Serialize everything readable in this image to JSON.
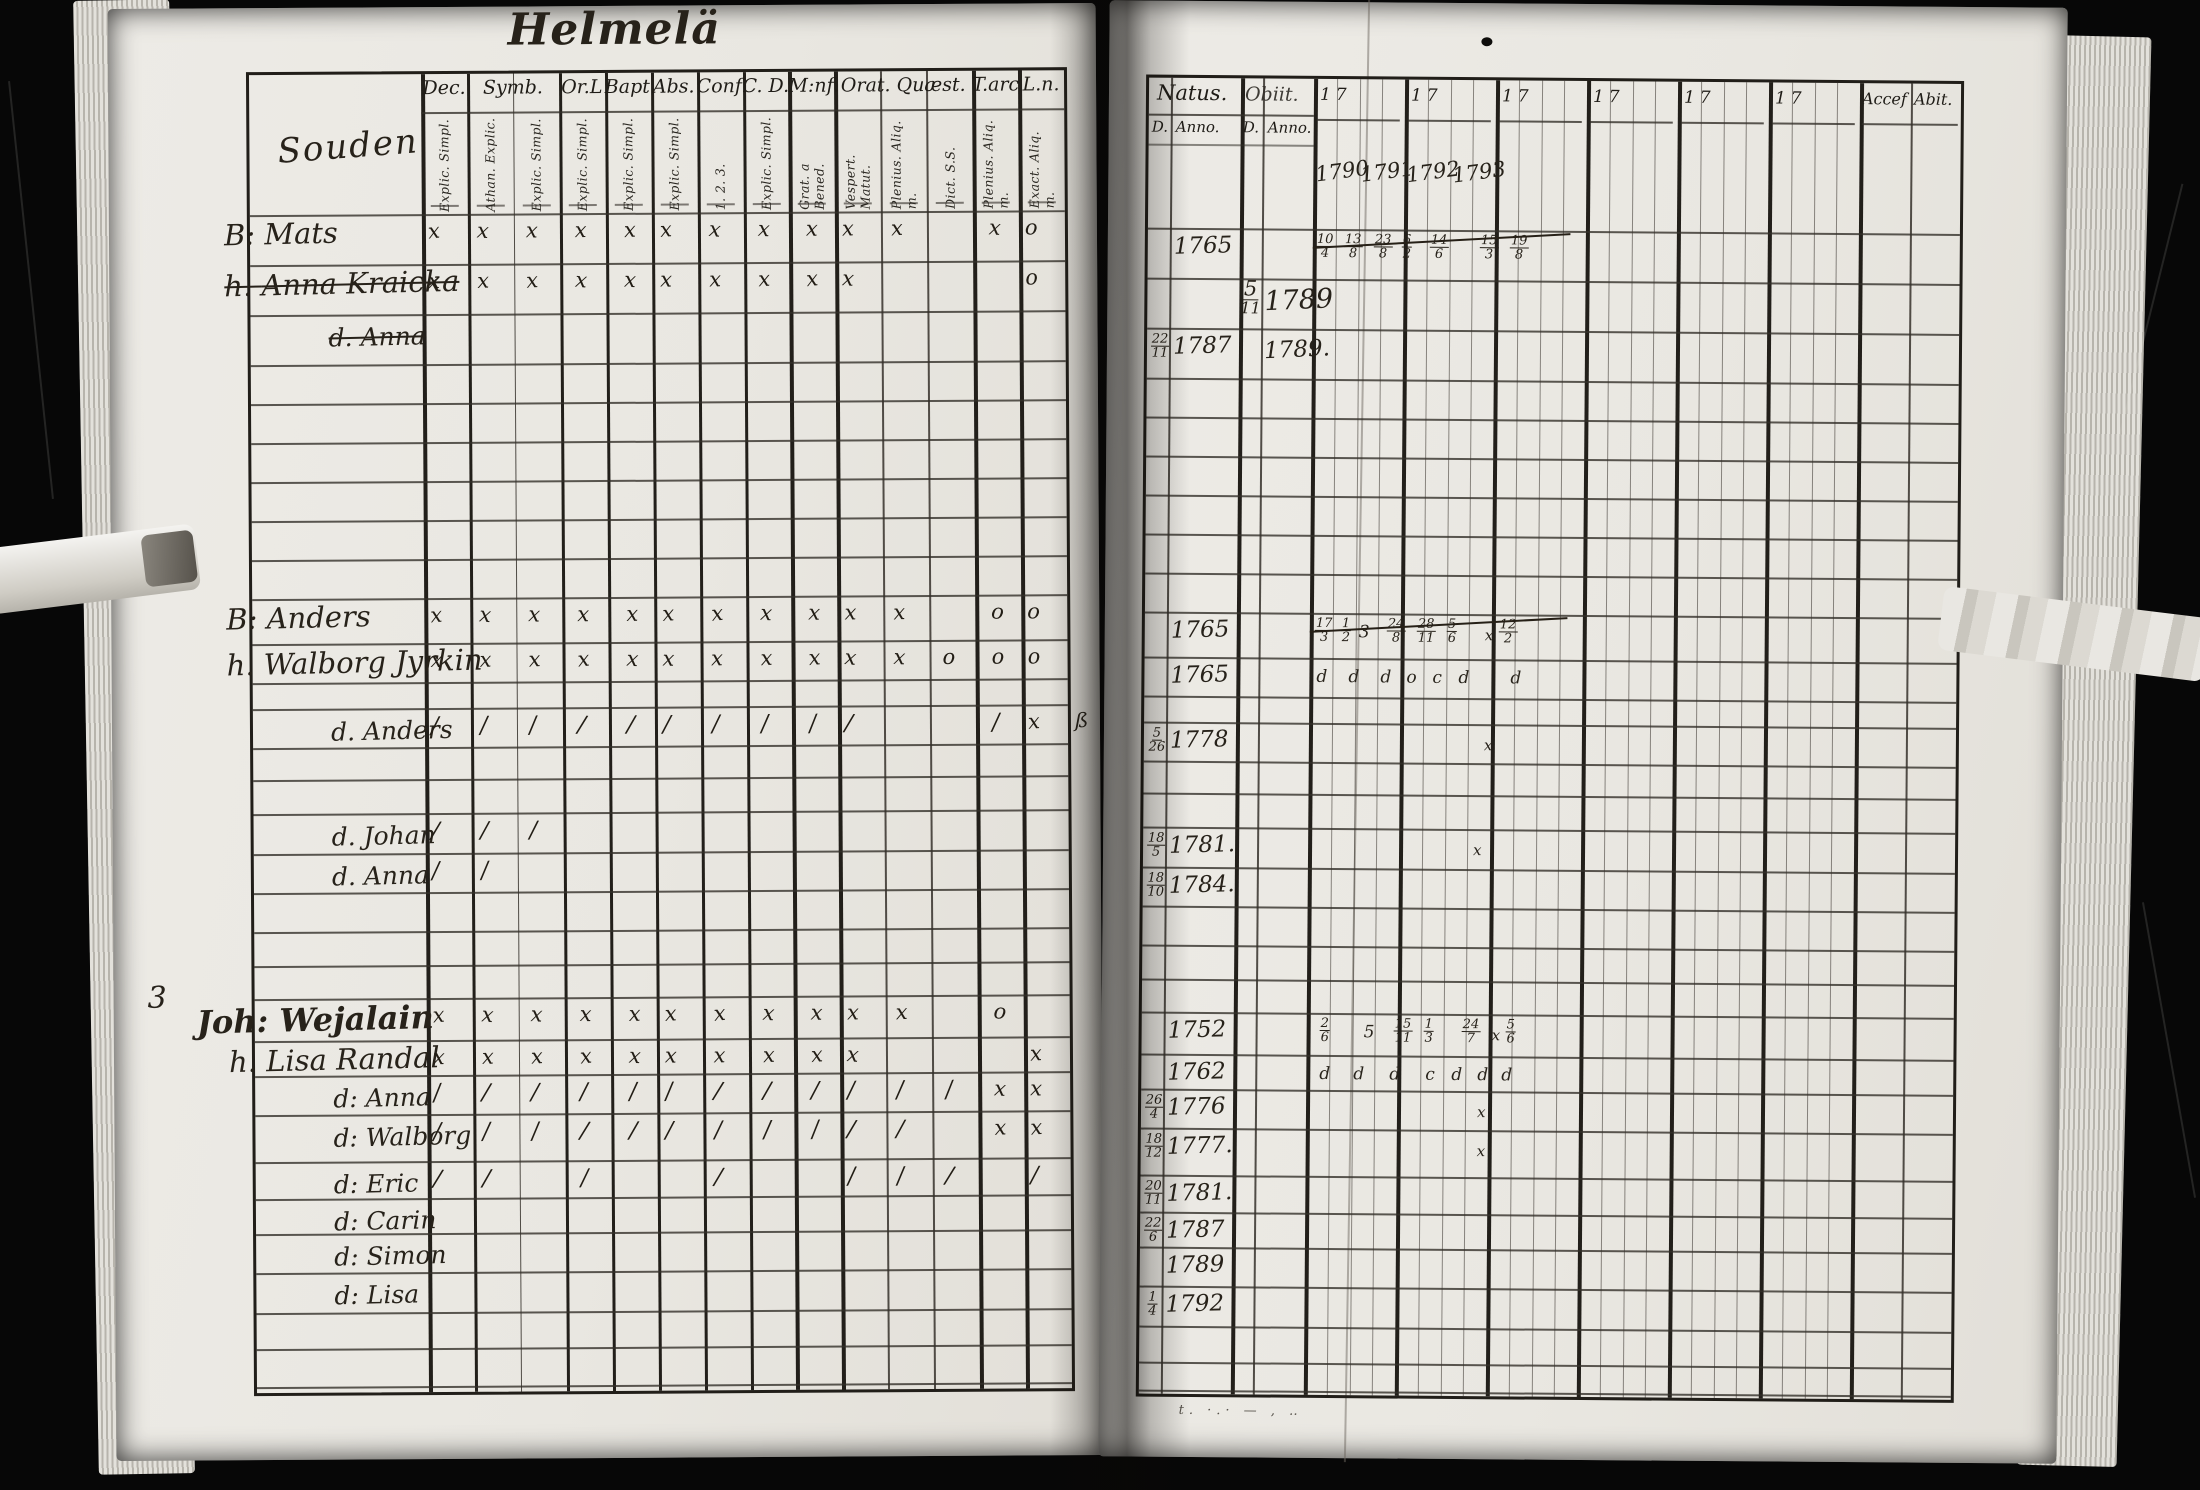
{
  "title": "Helmelä",
  "left_page": {
    "column_label": "Souden",
    "margin_note": "3",
    "header_groups": [
      {
        "label": "Dec.",
        "cols": [
          "Explic. Simpl."
        ]
      },
      {
        "label": "Symb.",
        "cols": [
          "Athan. Explic.",
          "Explic. Simpl."
        ]
      },
      {
        "label": "Or.L",
        "cols": [
          "Explic. Simpl."
        ]
      },
      {
        "label": "Bapt.",
        "cols": [
          "Explic. Simpl."
        ]
      },
      {
        "label": "Abs.",
        "cols": [
          "Explic. Simpl."
        ]
      },
      {
        "label": "Conf.",
        "cols": [
          "1. 2. 3."
        ]
      },
      {
        "label": "C. D.",
        "cols": [
          "Explic. Simpl."
        ]
      },
      {
        "label": "M:nf.",
        "cols": [
          "Grat. a Bened."
        ]
      },
      {
        "label": "Orat. Quæst.",
        "cols": [
          "Vespert. Matut.",
          "Plenius. Aliq. m.",
          "Dict. S.S."
        ]
      },
      {
        "label": "T.arc",
        "cols": [
          "Plenius. Aliq. m."
        ]
      },
      {
        "label": "L.n.",
        "cols": [
          "Exact. Aliq. m."
        ]
      }
    ]
  },
  "right_page": {
    "natus_label": "Natus.",
    "obiit_label": "Obiit.",
    "day_label": "D.",
    "anno_label": "Anno.",
    "year_prefix": "17",
    "written_years": [
      "1790",
      "1791",
      "1792",
      "1793"
    ],
    "accessit_label": "Accef",
    "abiit_label": "Abit.",
    "footer_scribble": "t. ·.· — , ‥"
  },
  "rows": [
    {
      "prefix": "B:",
      "name": "Mats",
      "struck": false,
      "child": false,
      "marks": [
        "x",
        "x",
        "x",
        "x",
        "x",
        "x",
        "x",
        "x",
        "x",
        "x",
        "x",
        "",
        "x",
        "o"
      ],
      "natus_anno": "1765",
      "notes_struck": true,
      "notes": [
        {
          "x": 168,
          "t": "10|4"
        },
        {
          "x": 196,
          "t": "13|8"
        },
        {
          "x": 226,
          "t": "23|8"
        },
        {
          "x": 254,
          "t": "6|2"
        },
        {
          "x": 282,
          "t": "14|6"
        },
        {
          "x": 332,
          "t": "15|3"
        },
        {
          "x": 362,
          "t": "19|8"
        }
      ]
    },
    {
      "prefix": "h.",
      "name": "Anna Kraicka",
      "struck": true,
      "child": false,
      "marks": [
        "x",
        "x",
        "x",
        "x",
        "x",
        "x",
        "x",
        "x",
        "x",
        "x",
        "",
        "",
        "",
        "o"
      ],
      "obiit_d": "5|11",
      "obiit_anno": "1789",
      "obiit_big": true
    },
    {
      "prefix": "d.",
      "name": "Anna",
      "struck": true,
      "child": true,
      "marks": [],
      "natus_d": "22|11",
      "natus_anno": "1787",
      "obiit_anno": "1789."
    },
    {},
    {},
    {},
    {},
    {},
    {},
    {
      "prefix": "B:",
      "name": "Anders",
      "struck": false,
      "child": false,
      "marks": [
        "x",
        "x",
        "x",
        "x",
        "x",
        "x",
        "x",
        "x",
        "x",
        "x",
        "x",
        "",
        "o",
        "o"
      ],
      "natus_anno": "1765",
      "notes_struck": true,
      "notes": [
        {
          "x": 170,
          "t": "17|3"
        },
        {
          "x": 196,
          "t": "1|2"
        },
        {
          "x": 214,
          "t": "3"
        },
        {
          "x": 242,
          "t": "24|8"
        },
        {
          "x": 272,
          "t": "28|11"
        },
        {
          "x": 302,
          "t": "5|6"
        },
        {
          "x": 340,
          "t": "x"
        },
        {
          "x": 354,
          "t": "12|2"
        }
      ]
    },
    {
      "prefix": "h.",
      "name": "Walborg Jyrkin",
      "struck": false,
      "child": false,
      "marks": [
        "x",
        "x",
        "x",
        "x",
        "x",
        "x",
        "x",
        "x",
        "x",
        "x",
        "x",
        "o",
        "o",
        "o"
      ],
      "natus_anno": "1765",
      "notes": [
        {
          "x": 172,
          "t": "d"
        },
        {
          "x": 204,
          "t": "d"
        },
        {
          "x": 236,
          "t": "d"
        },
        {
          "x": 262,
          "t": "o"
        },
        {
          "x": 288,
          "t": "c"
        },
        {
          "x": 314,
          "t": "d"
        },
        {
          "x": 366,
          "t": "d"
        }
      ]
    },
    {},
    {
      "prefix": "d.",
      "name": "Anders",
      "struck": false,
      "child": true,
      "marks": [
        "/",
        "/",
        "/",
        "/",
        "/",
        "/",
        "/",
        "/",
        "/",
        "/",
        "",
        "",
        "/",
        "x"
      ],
      "margin_right": "ß",
      "natus_d": "5|26",
      "natus_anno": "1778",
      "notes": [
        {
          "x": 340,
          "t": "x"
        }
      ]
    },
    {},
    {},
    {
      "prefix": "d.",
      "name": "Johan",
      "struck": false,
      "child": true,
      "marks": [
        "/",
        "/",
        "/",
        "",
        "",
        "",
        "",
        "",
        "",
        "",
        "",
        "",
        "",
        ""
      ],
      "natus_d": "18|5",
      "natus_anno": "1781.",
      "notes": [
        {
          "x": 330,
          "t": "x"
        }
      ]
    },
    {
      "prefix": "d.",
      "name": "Anna",
      "struck": false,
      "child": true,
      "marks": [
        "/",
        "/",
        "",
        "",
        "",
        "",
        "",
        "",
        "",
        "",
        "",
        "",
        "",
        ""
      ],
      "natus_d": "18|10",
      "natus_anno": "1784."
    },
    {},
    {},
    {},
    {
      "prefix": "",
      "name": "Joh: Wejalain",
      "struck": false,
      "child": false,
      "big": true,
      "marks": [
        "x",
        "x",
        "x",
        "x",
        "x",
        "x",
        "x",
        "x",
        "x",
        "x",
        "x",
        "",
        "o",
        ""
      ],
      "natus_anno": "1752",
      "notes": [
        {
          "x": 178,
          "t": "2|6"
        },
        {
          "x": 222,
          "t": "5"
        },
        {
          "x": 252,
          "t": "15|11"
        },
        {
          "x": 282,
          "t": "1|3"
        },
        {
          "x": 320,
          "t": "24|7"
        },
        {
          "x": 350,
          "t": "x"
        },
        {
          "x": 364,
          "t": "5|6"
        }
      ]
    },
    {
      "prefix": "h.",
      "name": "Lisa Randal",
      "struck": false,
      "child": false,
      "marks": [
        "x",
        "x",
        "x",
        "x",
        "x",
        "x",
        "x",
        "x",
        "x",
        "x",
        "",
        "",
        "",
        "x"
      ],
      "natus_anno": "1762",
      "notes": [
        {
          "x": 178,
          "t": "d"
        },
        {
          "x": 212,
          "t": "d"
        },
        {
          "x": 248,
          "t": "d"
        },
        {
          "x": 284,
          "t": "c"
        },
        {
          "x": 310,
          "t": "d"
        },
        {
          "x": 336,
          "t": "d"
        },
        {
          "x": 360,
          "t": "d"
        }
      ]
    },
    {
      "prefix": "d:",
      "name": "Anna",
      "struck": false,
      "child": true,
      "marks": [
        "/",
        "/",
        "/",
        "/",
        "/",
        "/",
        "/",
        "/",
        "/",
        "/",
        "/",
        "/",
        "x",
        "x"
      ],
      "natus_d": "26|4",
      "natus_anno": "1776",
      "notes": [
        {
          "x": 336,
          "t": "x"
        }
      ]
    },
    {
      "prefix": "d:",
      "name": "Walborg",
      "struck": false,
      "child": true,
      "marks": [
        "/",
        "/",
        "/",
        "/",
        "/",
        "/",
        "/",
        "/",
        "/",
        "/",
        "/",
        "",
        "x",
        "x"
      ],
      "natus_d": "18|12",
      "natus_anno": "1777.",
      "notes": [
        {
          "x": 336,
          "t": "x"
        }
      ]
    },
    {
      "prefix": "d:",
      "name": "Eric",
      "struck": false,
      "child": true,
      "marks": [
        "/",
        "/",
        "",
        "/",
        "",
        "",
        "/",
        "",
        "",
        "/",
        "/",
        "/",
        "",
        "/"
      ],
      "natus_d": "20|11",
      "natus_anno": "1781."
    },
    {
      "prefix": "d:",
      "name": "Carin",
      "struck": false,
      "child": true,
      "marks": [],
      "natus_d": "22|6",
      "natus_anno": "1787"
    },
    {
      "prefix": "d:",
      "name": "Simon",
      "struck": false,
      "child": true,
      "marks": [],
      "natus_anno": "1789"
    },
    {
      "prefix": "d:",
      "name": "Lisa",
      "struck": false,
      "child": true,
      "marks": [],
      "natus_d": "1|4",
      "natus_anno": "1792"
    },
    {},
    {}
  ]
}
